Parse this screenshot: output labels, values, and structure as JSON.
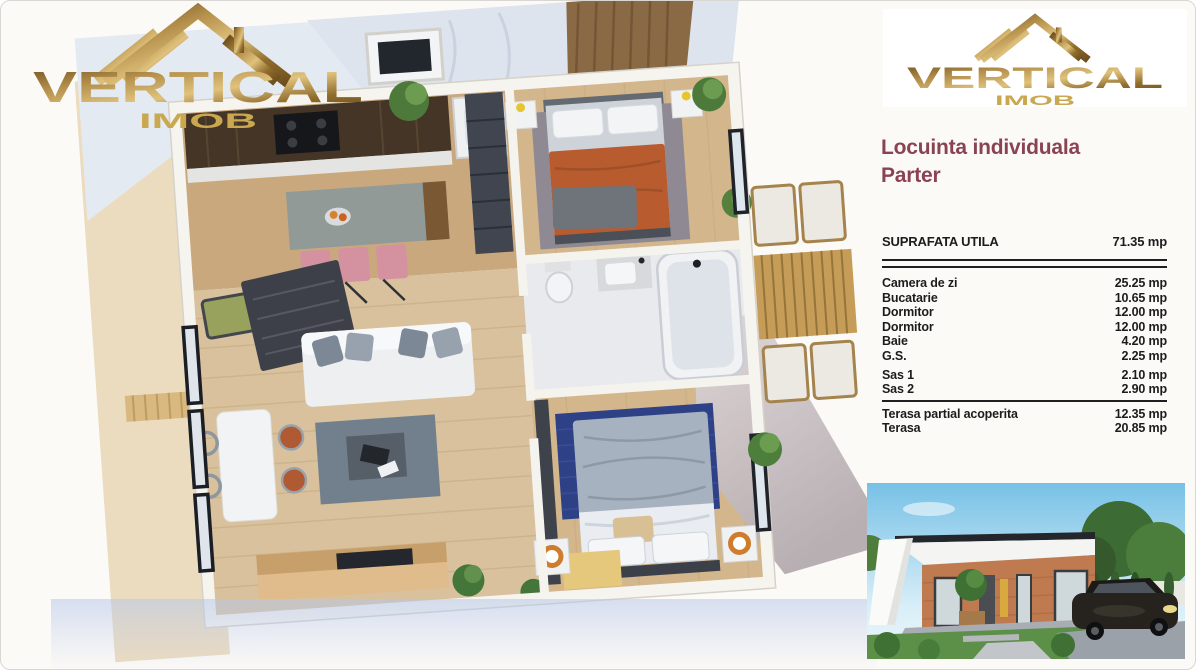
{
  "brand": {
    "name": "VERTICAL",
    "sub": "IMOB",
    "gold_dark": "#7a5a22",
    "gold_light": "#c9a84f"
  },
  "panel": {
    "title_line1": "Locuinta individuala",
    "title_line2": "Parter",
    "title_color": "#8a4352",
    "summary": {
      "label": "SUPRAFATA UTILA",
      "value": "71.35 mp"
    },
    "rooms": [
      {
        "label": "Camera de zi",
        "value": "25.25 mp"
      },
      {
        "label": "Bucatarie",
        "value": "10.65 mp"
      },
      {
        "label": "Dormitor",
        "value": "12.00 mp"
      },
      {
        "label": "Dormitor",
        "value": "12.00 mp"
      },
      {
        "label": "Baie",
        "value": "4.20 mp"
      },
      {
        "label": "G.S.",
        "value": "2.25 mp"
      },
      {
        "label": "Sas 1",
        "value": "2.10 mp"
      },
      {
        "label": "Sas 2",
        "value": "2.90 mp"
      }
    ],
    "terrace_rows": [
      {
        "label": "Terasa partial acoperita",
        "value": "12.35 mp"
      },
      {
        "label": "Terasa",
        "value": "20.85 mp"
      }
    ]
  }
}
